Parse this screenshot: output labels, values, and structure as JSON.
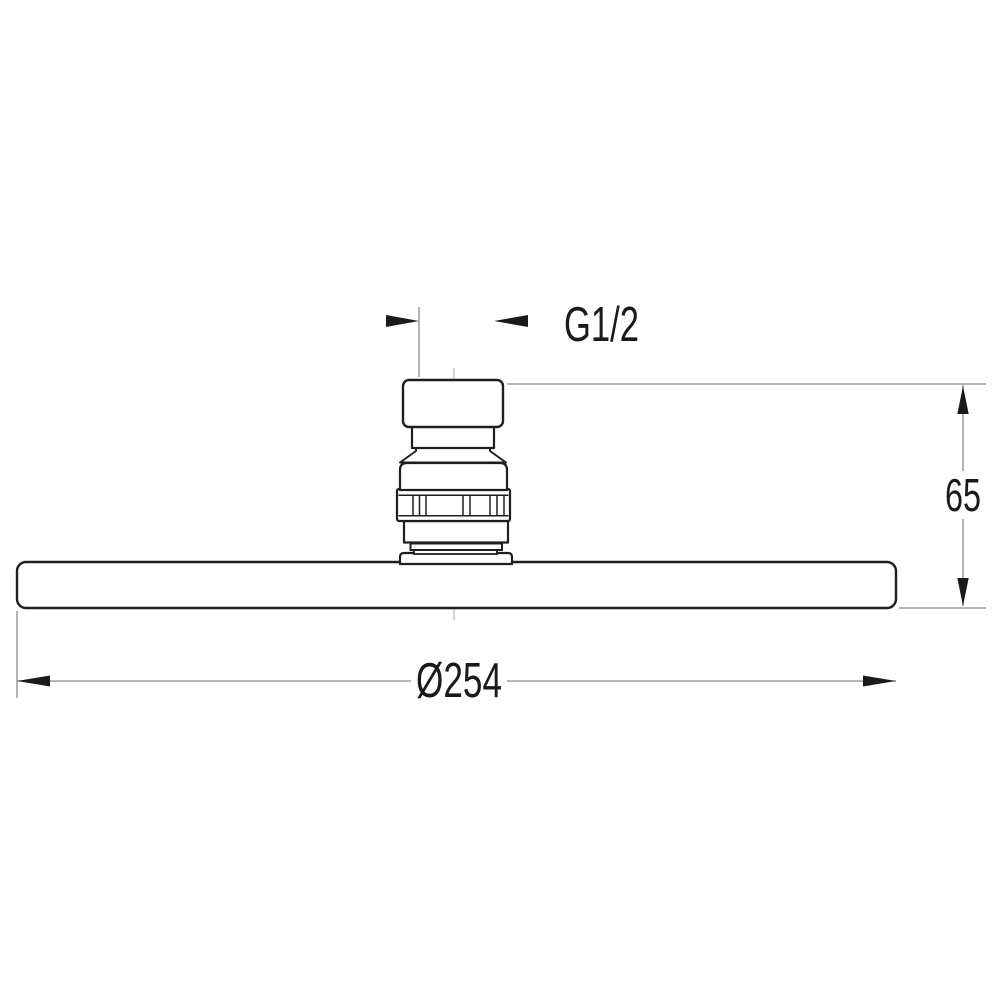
{
  "dimensions": {
    "thread": {
      "label": "G1/2"
    },
    "height": {
      "label": "65"
    },
    "diameter": {
      "label": "Ø254"
    }
  },
  "colors": {
    "outline": "#1f1f1f",
    "dimension_line": "#8a8a8a",
    "centerline": "#b3b3b3",
    "arrow": "#1a1a1a",
    "background": "#ffffff"
  }
}
